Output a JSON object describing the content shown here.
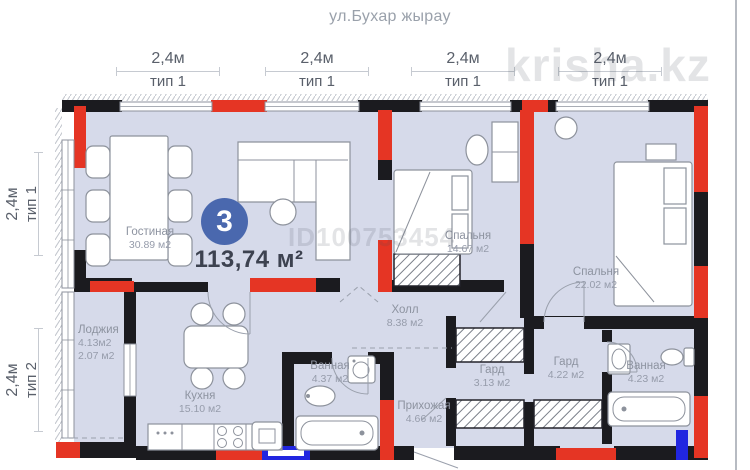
{
  "header": {
    "street_label": "ул.Бухар жырау"
  },
  "watermarks": {
    "site": "krisha.kz",
    "listing_id": "ID100753454"
  },
  "unit": {
    "rooms_count": "3",
    "total_area": "113,74 м²"
  },
  "dimensions": {
    "top": [
      {
        "length": "2,4м",
        "type": "тип 1"
      },
      {
        "length": "2,4м",
        "type": "тип 1"
      },
      {
        "length": "2,4м",
        "type": "тип 1"
      },
      {
        "length": "2,4м",
        "type": "тип 1"
      }
    ],
    "left": [
      {
        "length": "2,4м",
        "type": "тип 1"
      },
      {
        "length": "2,4м",
        "type": "тип 2"
      }
    ]
  },
  "rooms": [
    {
      "name": "Гостиная",
      "area": "30.89 м2"
    },
    {
      "name": "Спальня",
      "area": "14.67 м2"
    },
    {
      "name": "Спальня",
      "area": "22.02 м2"
    },
    {
      "name": "Холл",
      "area": "8.38 м2"
    },
    {
      "name": "Кухня",
      "area": "15.10 м2"
    },
    {
      "name": "Лоджия",
      "area": "4.13м2",
      "area2": "2.07 м2"
    },
    {
      "name": "Ванная",
      "area": "4.37 м2"
    },
    {
      "name": "Прихожая",
      "area": "4.66 м2"
    },
    {
      "name": "Гард",
      "area": "3.13 м2"
    },
    {
      "name": "Гард",
      "area": "4.22 м2"
    },
    {
      "name": "Ванная",
      "area": "4.23 м2"
    }
  ],
  "colors": {
    "wall_red": "#e53524",
    "wall_black": "#1b1b1f",
    "wall_blue": "#2126e0",
    "floor": "#d6daea",
    "badge_blue": "#4a68ae"
  }
}
